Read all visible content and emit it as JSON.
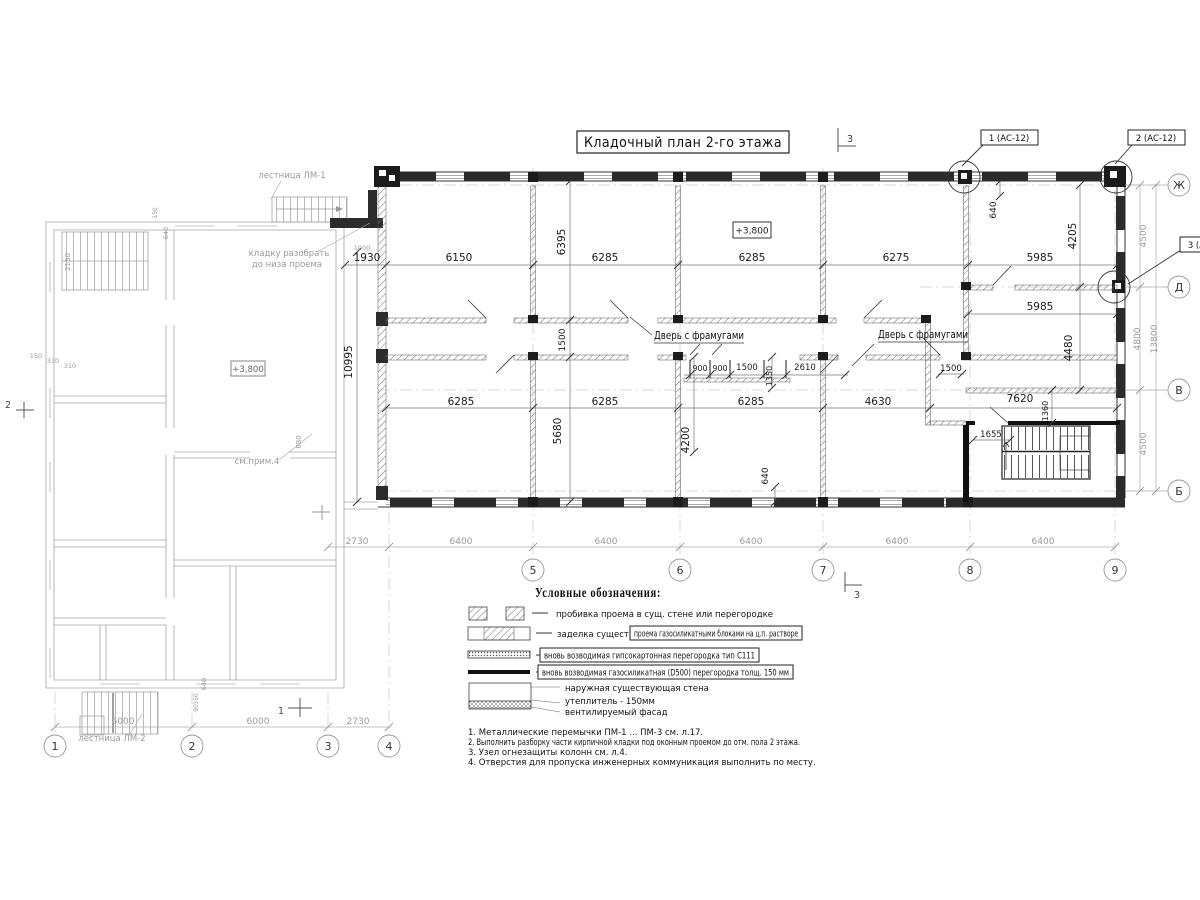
{
  "title": {
    "text": "Кладочный план 2-го этажа"
  },
  "axes": {
    "bottom": [
      "1",
      "2",
      "3",
      "4",
      "5",
      "6",
      "7",
      "8",
      "9"
    ],
    "right": [
      "Ж",
      "Д",
      "В",
      "Б"
    ]
  },
  "callouts": [
    {
      "label": "1 (АС-12)"
    },
    {
      "label": "2 (АС-12)"
    },
    {
      "label": "3 (АС-12)"
    }
  ],
  "section_marks": {
    "top": "3",
    "bottom": "3",
    "left": "1",
    "side": "2"
  },
  "labels": {
    "door_transom_1": "Дверь с фрамугами",
    "door_transom_2": "Дверь с фрамугами",
    "level_mark_main": "+3,800",
    "level_mark_left": "+3,800",
    "stair_top": "лестница ЛМ-1",
    "stair_bottom": "лестница ЛМ-2",
    "demolish_1": "кладку разобрать",
    "demolish_2": "до низа проема",
    "see_note": "см.прим.4"
  },
  "legend": {
    "header": "Условные обозначения:",
    "items": [
      {
        "text": "пробивка проема в сущ. стене или перегородке"
      },
      {
        "prefix": "заделка существ.",
        "text": "проема газосиликатными блоками на ц.п. растворе"
      },
      {
        "text": "вновь возводимая гипсокартонная перегородка тип С111"
      },
      {
        "text": "вновь возводимая газосиликатная (D500) перегородка толщ. 150 мм"
      }
    ],
    "wall": [
      "наружная существующая стена",
      "утеплитель - 150мм",
      "вентилируемый фасад"
    ]
  },
  "notes": [
    "1. Металлические перемычки  ПМ-1 ... ПМ-3 см. л.17.",
    "2. Выполнить разборку части кирпичной кладки под оконным проемом до отм. пола 2 этажа.",
    "3. Узел огнезащиты колонн см. л.4.",
    "4. Отверстия для пропуска инженерных коммуникация выполнить по месту."
  ],
  "dimensions": {
    "placed": [
      {
        "t": "1930",
        "x": 367,
        "y": 261
      },
      {
        "t": "6150",
        "x": 459,
        "y": 261
      },
      {
        "t": "6285",
        "x": 605,
        "y": 261
      },
      {
        "t": "6285",
        "x": 752,
        "y": 261
      },
      {
        "t": "6275",
        "x": 896,
        "y": 261
      },
      {
        "t": "5985",
        "x": 1040,
        "y": 261
      },
      {
        "t": "5985",
        "x": 1040,
        "y": 310
      },
      {
        "t": "6395",
        "x": 565,
        "y": 242,
        "r": -90
      },
      {
        "t": "640",
        "x": 996,
        "y": 210,
        "r": -90,
        "s": 9
      },
      {
        "t": "4205",
        "x": 1076,
        "y": 236,
        "r": -90
      },
      {
        "t": "4480",
        "x": 1072,
        "y": 348,
        "r": -90
      },
      {
        "t": "1500",
        "x": 565,
        "y": 340,
        "r": -90,
        "s": 9
      },
      {
        "t": "10995",
        "x": 352,
        "y": 362,
        "r": -90
      },
      {
        "t": "900",
        "x": 700,
        "y": 371,
        "s": 8
      },
      {
        "t": "900",
        "x": 720,
        "y": 371,
        "s": 8
      },
      {
        "t": "1500",
        "x": 747,
        "y": 370,
        "s": 8.5
      },
      {
        "t": "1350",
        "x": 772,
        "y": 376,
        "r": -90,
        "s": 8
      },
      {
        "t": "2610",
        "x": 805,
        "y": 370,
        "s": 8.5
      },
      {
        "t": "1500",
        "x": 951,
        "y": 371,
        "s": 8.5
      },
      {
        "t": "6285",
        "x": 461,
        "y": 405
      },
      {
        "t": "6285",
        "x": 605,
        "y": 405
      },
      {
        "t": "6285",
        "x": 751,
        "y": 405
      },
      {
        "t": "4630",
        "x": 878,
        "y": 405
      },
      {
        "t": "7620",
        "x": 1020,
        "y": 402
      },
      {
        "t": "1360",
        "x": 1048,
        "y": 411,
        "r": -90,
        "s": 8
      },
      {
        "t": "1655",
        "x": 991,
        "y": 437,
        "s": 8.5
      },
      {
        "t": "5680",
        "x": 561,
        "y": 431,
        "r": -90
      },
      {
        "t": "4200",
        "x": 689,
        "y": 440,
        "r": -90
      },
      {
        "t": "640",
        "x": 768,
        "y": 476,
        "r": -90,
        "s": 9
      },
      {
        "t": "2730",
        "x": 357,
        "y": 544,
        "g": 1
      },
      {
        "t": "6400",
        "x": 461,
        "y": 544,
        "g": 1
      },
      {
        "t": "6400",
        "x": 606,
        "y": 544,
        "g": 1
      },
      {
        "t": "6400",
        "x": 751,
        "y": 544,
        "g": 1
      },
      {
        "t": "6400",
        "x": 897,
        "y": 544,
        "g": 1
      },
      {
        "t": "6400",
        "x": 1043,
        "y": 544,
        "g": 1
      },
      {
        "t": "6000",
        "x": 123,
        "y": 724,
        "g": 1
      },
      {
        "t": "6000",
        "x": 258,
        "y": 724,
        "g": 1
      },
      {
        "t": "2730",
        "x": 358,
        "y": 724,
        "g": 1
      },
      {
        "t": "4500",
        "x": 1146,
        "y": 236,
        "r": -90,
        "g": 1
      },
      {
        "t": "4800",
        "x": 1140,
        "y": 339,
        "r": -90,
        "g": 1
      },
      {
        "t": "13800",
        "x": 1157,
        "y": 339,
        "r": -90,
        "g": 1
      },
      {
        "t": "4500",
        "x": 1146,
        "y": 444,
        "r": -90,
        "g": 1
      },
      {
        "t": "2150",
        "x": 70,
        "y": 262,
        "r": -90,
        "g": 1,
        "s": 7
      },
      {
        "t": "150",
        "x": 36,
        "y": 358,
        "g": 1,
        "s": 6.5
      },
      {
        "t": "330",
        "x": 53,
        "y": 363,
        "g": 1,
        "s": 6.5
      },
      {
        "t": "310",
        "x": 70,
        "y": 368,
        "g": 1,
        "s": 6.5
      },
      {
        "t": "680",
        "x": 301,
        "y": 442,
        "r": -90,
        "g": 1,
        "s": 7
      },
      {
        "t": "1000",
        "x": 362,
        "y": 250,
        "g": 1,
        "s": 6.5
      },
      {
        "t": "150",
        "x": 157,
        "y": 213,
        "r": -90,
        "g": 1,
        "s": 6
      },
      {
        "t": "640",
        "x": 168,
        "y": 233,
        "r": -90,
        "g": 1,
        "s": 6.5
      },
      {
        "t": "640",
        "x": 206,
        "y": 684,
        "r": -90,
        "g": 1,
        "s": 6.5
      },
      {
        "t": "150",
        "x": 198,
        "y": 699,
        "r": -90,
        "g": 1,
        "s": 6
      },
      {
        "t": "90",
        "x": 198,
        "y": 708,
        "r": -90,
        "g": 1,
        "s": 6
      }
    ]
  }
}
